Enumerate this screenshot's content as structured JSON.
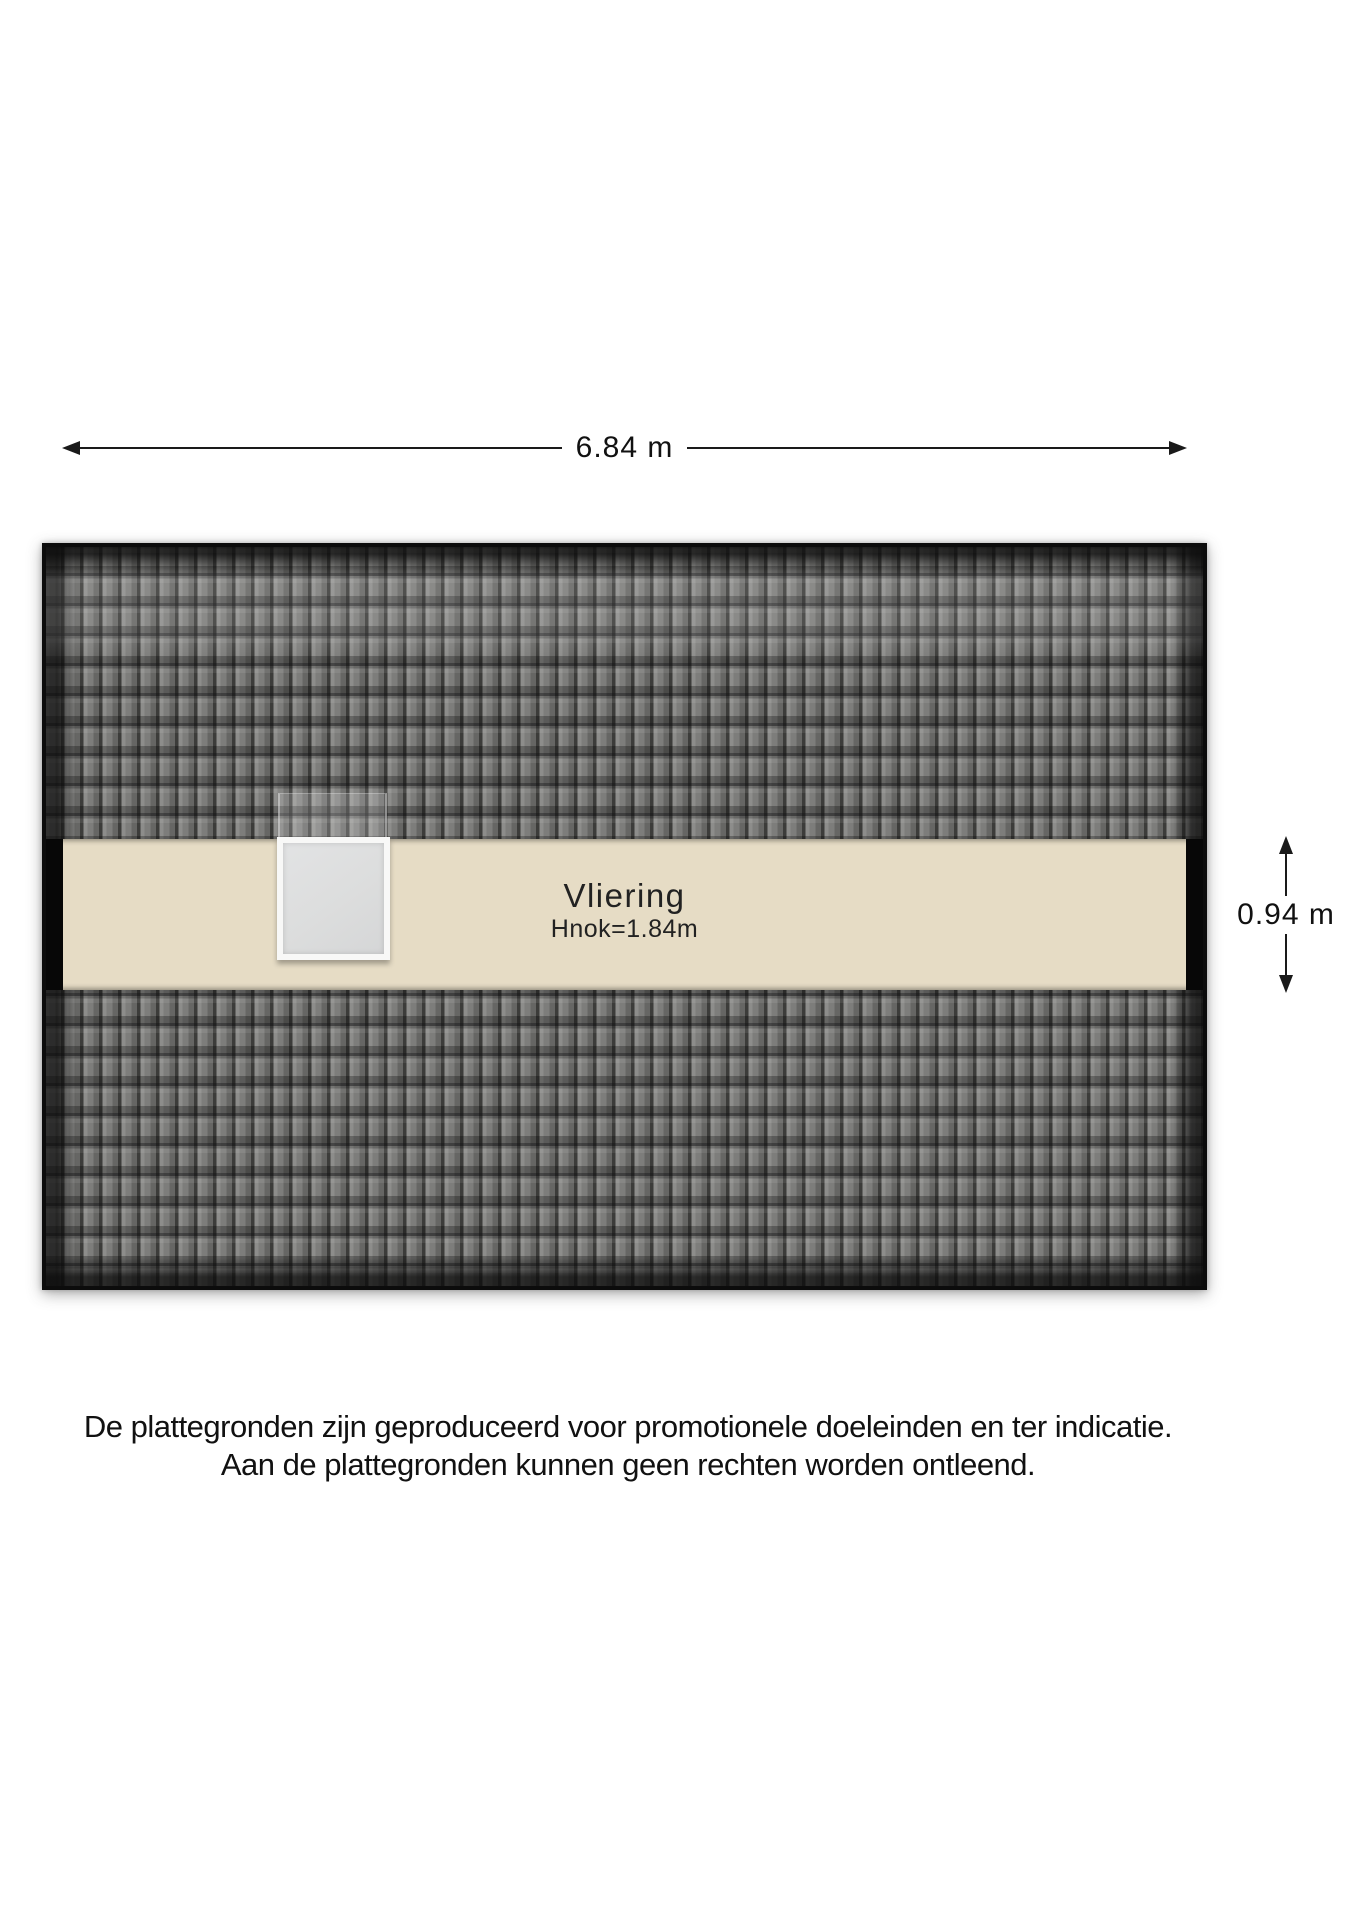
{
  "floorplan": {
    "dimensions": {
      "width_label": "6.84 m",
      "height_label": "0.94 m"
    },
    "room": {
      "name": "Vliering",
      "height_label": "Hnok=1.84m"
    },
    "icons": {
      "arrow_left": "arrow-left-icon",
      "arrow_right": "arrow-right-icon",
      "arrow_up": "arrow-up-icon",
      "arrow_down": "arrow-down-icon"
    },
    "colors": {
      "roof_tile": "#7a7a78",
      "roof_edge": "#0c0c0c",
      "floor_beige": "#e6dcc5",
      "wall_black": "#070707",
      "skylight_glass": "#dcdddd",
      "skylight_frame": "#f8f8f7",
      "dimension_line": "#1a1a1a"
    }
  },
  "disclaimer": {
    "line1": "De plattegronden zijn geproduceerd voor promotionele doeleinden en ter indicatie.",
    "line2": "Aan de plattegronden kunnen geen rechten worden ontleend."
  }
}
